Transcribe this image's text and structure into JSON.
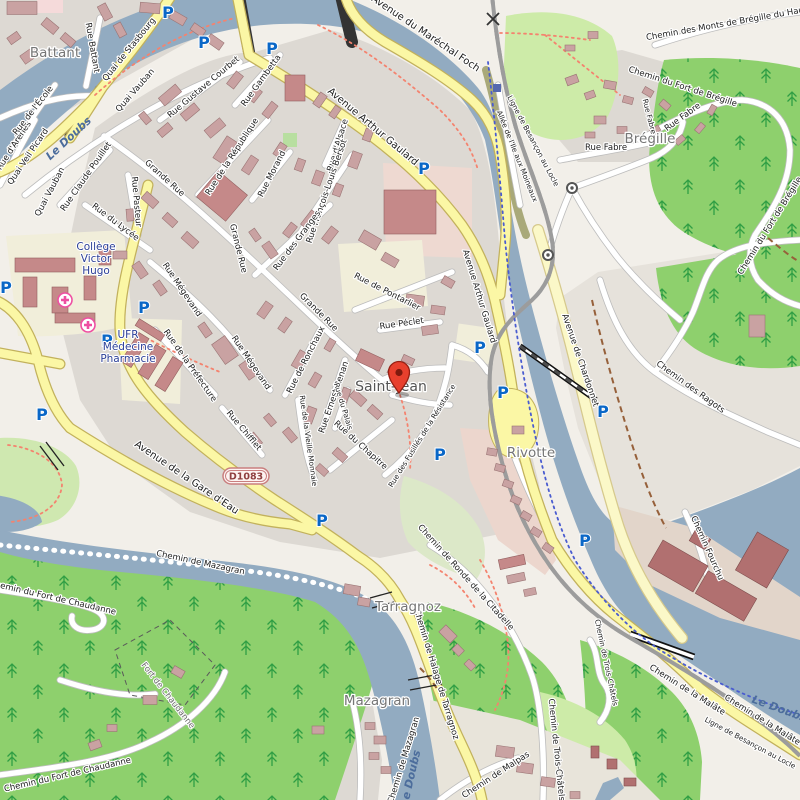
{
  "map": {
    "kind": "street-map",
    "marker": {
      "name": "location-pin",
      "area": "Saint-Jean"
    }
  },
  "labels": {
    "battant": "Battant",
    "rue_battant": "Rue Battant",
    "quai_de_stasbourg": "Quai de Stasbourg",
    "quai_vauban": "Quai Vauban",
    "quai_veil_picard": "Quai Veil Picard",
    "rue_d_arenes": "Rue d'Arènes",
    "rue_de_l_ecole": "Rue de l'École",
    "rue_claude_pouillet": "Rue Claude Pouillet",
    "le_doubs": "Le Doubs",
    "rue_gustave_courbet": "Rue Gustave Courbet",
    "rue_gambetta": "Rue Gambetta",
    "avenue_du_marechal_foch": "Avenue du Maréchal Foch",
    "avenue_arthur_gaulard": "Avenue Arthur Gaulard",
    "rue_d_alsace": "Rue d'Alsace",
    "rue_morand": "Rue Morand",
    "rue_de_la_republique": "Rue de la République",
    "rue_francois_louis_bersot": "Rue François-Louis Bersot",
    "rue_des_granges": "Rue des Granges",
    "grande_rue": "Grande Rue",
    "rue_pasteur": "Rue Pasteur",
    "rue_du_lycee": "Rue du Lycée",
    "rue_de_pontarlier": "Rue de Pontarlier",
    "rue_peclet": "Rue Péclet",
    "rue_megevand": "Rue Mégevand",
    "rue_de_la_prefecture": "Rue de la Préfecture",
    "rue_chifflet": "Rue Chifflet",
    "rue_de_ronchaux": "Rue de Ronchaux",
    "rue_ernest_renan": "Rue Ernest Renan",
    "rue_de_la_vieille_monnaie": "Rue de la Vieille Monnaie",
    "rue_du_palais": "Rue du Palais",
    "rue_du_chapitre": "Rue du Chapitre",
    "saint_jean": "Saint-Jean",
    "rue_des_fusilles": "Rue des Fusillés de la Résistance",
    "avenue_de_chardonnet": "Avenue de Chardonnet",
    "chemin_des_ragots": "Chemin des Ragots",
    "rivotte": "Rivotte",
    "ligne_besancon_locle": "Ligne de Besançon au Locle",
    "allee_ile_moineaux": "Allée de l'Ile aux Moineaux",
    "rue_fabre": "Rue Fabre",
    "bregille": "Brégille",
    "chemin_monts_bregille": "Chemin des Monts de Brégille du Haut",
    "chemin_fort_bregille": "Chemin du Fort de Brégille",
    "avenue_gare_d_eau": "Avenue de la Gare d'Eau",
    "d1083": "D1083",
    "chemin_de_mazagran": "Chemin de Mazagran",
    "chemin_fort_chaudanne": "Chemin du Fort de Chaudanne",
    "fort_de_chaudanne": "Fort de Chaudanne",
    "mazagran": "Mazagran",
    "tarragnoz": "Tarragnoz",
    "chemin_halage_tarragnoz": "Chemin de Halage de Tarragnoz",
    "chemin_ronde_citadelle": "Chemin de Ronde de la Citadelle",
    "chemin_trois_chatels": "Chemin de Trois-Châtels",
    "chemin_de_malpas": "Chemin de Malpas",
    "chemin_fourchu": "Chemin Fourchu",
    "chemin_de_la_malate": "Chemin de la Malâte",
    "college_l1": "Collège",
    "college_l2": "Victor",
    "college_l3": "Hugo",
    "ufr_l1": "UFR",
    "ufr_l2": "Médecine",
    "ufr_l3": "Pharmacie",
    "parking": "P"
  },
  "icons": {
    "parking-icon": "P",
    "hospital-icon": "circled plus",
    "station-icon": "circled dot",
    "level-crossing-icon": "x-cross",
    "location-pin-icon": "red teardrop pin"
  },
  "colors": {
    "water": "#92abc1",
    "urban": "#ddd9d3",
    "forest": "#8ed06d",
    "light_green": "#cdeba8",
    "cream": "#f1eeda",
    "road_yellow": "#fbf7a5",
    "road_white": "#ffffff",
    "building": "#c9a2a2",
    "industrial_building": "#b17070",
    "parking_blue": "#0a67c7",
    "hospital_pink": "#ee4fa2",
    "pin_red": "#e8402d",
    "dotted_path_red": "#f4836f",
    "dotted_path_blue": "#4a5cd0",
    "dashed_path_brown": "#96603a"
  }
}
